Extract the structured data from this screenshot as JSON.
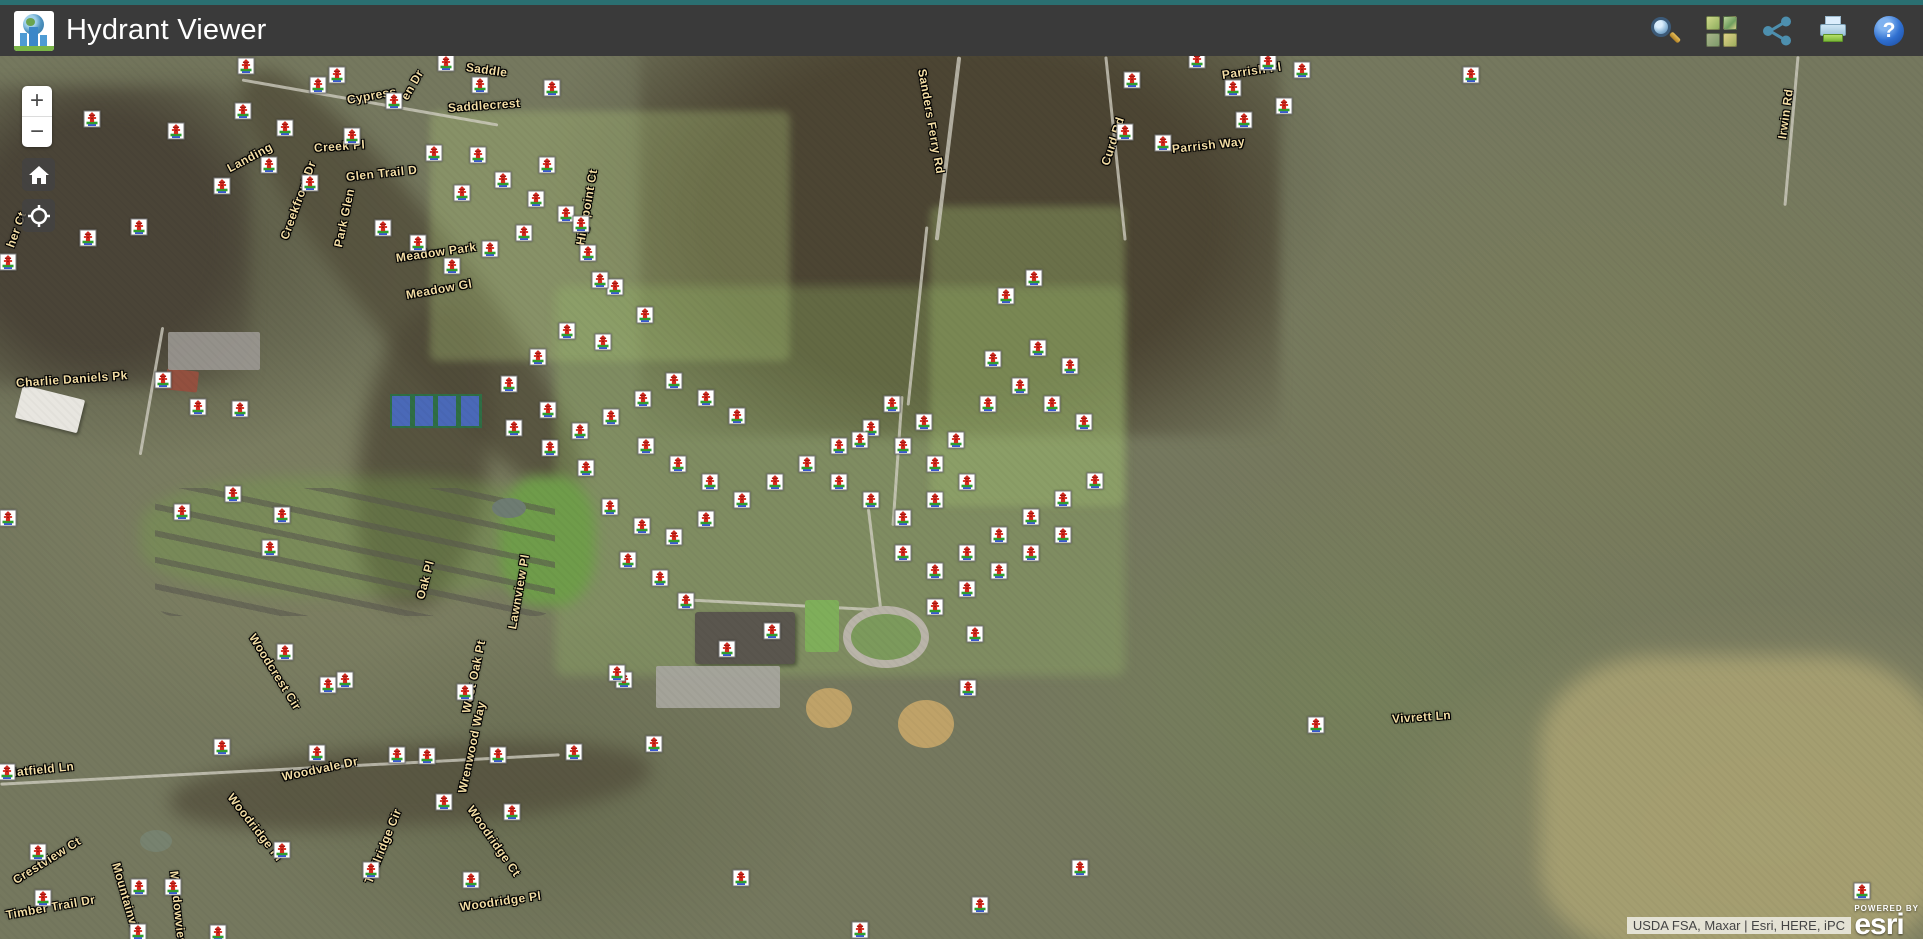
{
  "header": {
    "title": "Hydrant Viewer",
    "toolbar": [
      {
        "icon": "search-icon"
      },
      {
        "icon": "basemap-gallery-icon"
      },
      {
        "icon": "share-icon"
      },
      {
        "icon": "print-icon"
      },
      {
        "icon": "help-icon"
      }
    ]
  },
  "controls": {
    "zoom_in": "+",
    "zoom_out": "−"
  },
  "attribution": {
    "text": "USDA FSA, Maxar | Esri, HERE, iPC",
    "powered_by": "POWERED BY",
    "brand": "esri"
  },
  "colors": {
    "top_stripe": "#2a6f71",
    "header_bg": "#3a3a3a",
    "hydrant_red": "#d42a1e",
    "hydrant_grass": "#2e9e2e",
    "hydrant_blue": "#2244cc",
    "street_label": "#f3dda4"
  },
  "street_labels": [
    {
      "text": "Cypress",
      "x": 347,
      "y": 93,
      "rot": -10
    },
    {
      "text": "en Dr",
      "x": 404,
      "y": 92,
      "rot": -60
    },
    {
      "text": "Saddle",
      "x": 466,
      "y": 60,
      "rot": 8
    },
    {
      "text": "Saddlecrest",
      "x": 448,
      "y": 101,
      "rot": -4
    },
    {
      "text": "Creek Pl",
      "x": 314,
      "y": 141,
      "rot": -4
    },
    {
      "text": "Landing",
      "x": 228,
      "y": 162,
      "rot": -28
    },
    {
      "text": "Creekfront Dr",
      "x": 284,
      "y": 232,
      "rot": -70
    },
    {
      "text": "Glen Trail D",
      "x": 346,
      "y": 170,
      "rot": -6
    },
    {
      "text": "Park Glen",
      "x": 338,
      "y": 240,
      "rot": -78
    },
    {
      "text": "Highpoint Ct",
      "x": 580,
      "y": 238,
      "rot": -80
    },
    {
      "text": "Meadow Park",
      "x": 396,
      "y": 251,
      "rot": -8
    },
    {
      "text": "Meadow Gl",
      "x": 406,
      "y": 288,
      "rot": -10
    },
    {
      "text": "Sanders Ferry Rd",
      "x": 922,
      "y": 62,
      "rot": 80
    },
    {
      "text": "Curd Rd",
      "x": 1105,
      "y": 158,
      "rot": -72
    },
    {
      "text": "Parrish Pl",
      "x": 1222,
      "y": 68,
      "rot": -8
    },
    {
      "text": "Parrish Way",
      "x": 1172,
      "y": 142,
      "rot": -6
    },
    {
      "text": "Irwin Rd",
      "x": 1782,
      "y": 132,
      "rot": -82
    },
    {
      "text": "Charlie Daniels Pk",
      "x": 16,
      "y": 376,
      "rot": -4
    },
    {
      "text": "her Ct",
      "x": 10,
      "y": 240,
      "rot": -70
    },
    {
      "text": "Woodcrest Cir",
      "x": 252,
      "y": 628,
      "rot": 58
    },
    {
      "text": "Woodvale Dr",
      "x": 282,
      "y": 770,
      "rot": -12
    },
    {
      "text": "Wrenwood Way",
      "x": 462,
      "y": 786,
      "rot": -78
    },
    {
      "text": "West Oak Pt",
      "x": 466,
      "y": 706,
      "rot": -78
    },
    {
      "text": "Oak Pl",
      "x": 420,
      "y": 592,
      "rot": -75
    },
    {
      "text": "Lawnview Pl",
      "x": 512,
      "y": 622,
      "rot": -80
    },
    {
      "text": "Hatfield Ln",
      "x": 8,
      "y": 766,
      "rot": -6
    },
    {
      "text": "Crestview Ct",
      "x": 14,
      "y": 874,
      "rot": -32
    },
    {
      "text": "Timber Trail Dr",
      "x": 6,
      "y": 908,
      "rot": -10
    },
    {
      "text": "Mountainview Dr",
      "x": 116,
      "y": 856,
      "rot": 74
    },
    {
      "text": "Meadowview Ln",
      "x": 174,
      "y": 864,
      "rot": 84
    },
    {
      "text": "Woodridge Pl",
      "x": 230,
      "y": 788,
      "rot": 52
    },
    {
      "text": "Trailridge Cir",
      "x": 368,
      "y": 876,
      "rot": -68
    },
    {
      "text": "Woodridge Ct",
      "x": 470,
      "y": 800,
      "rot": 55
    },
    {
      "text": "Woodridge Pl",
      "x": 460,
      "y": 900,
      "rot": -8
    },
    {
      "text": "Vivrett Ln",
      "x": 1392,
      "y": 712,
      "rot": -4
    }
  ],
  "hydrants": [
    [
      337,
      75
    ],
    [
      394,
      101
    ],
    [
      480,
      85
    ],
    [
      552,
      88
    ],
    [
      285,
      128
    ],
    [
      434,
      153
    ],
    [
      478,
      155
    ],
    [
      547,
      165
    ],
    [
      92,
      119
    ],
    [
      176,
      131
    ],
    [
      243,
      111
    ],
    [
      222,
      186
    ],
    [
      139,
      227
    ],
    [
      88,
      238
    ],
    [
      8,
      262
    ],
    [
      269,
      165
    ],
    [
      310,
      183
    ],
    [
      352,
      136
    ],
    [
      246,
      66
    ],
    [
      318,
      85
    ],
    [
      446,
      63
    ],
    [
      1132,
      80
    ],
    [
      1125,
      132
    ],
    [
      1163,
      143
    ],
    [
      1197,
      60
    ],
    [
      1233,
      88
    ],
    [
      1268,
      62
    ],
    [
      1284,
      106
    ],
    [
      1302,
      70
    ],
    [
      1244,
      120
    ],
    [
      1471,
      75
    ],
    [
      462,
      193
    ],
    [
      503,
      180
    ],
    [
      536,
      199
    ],
    [
      566,
      214
    ],
    [
      524,
      233
    ],
    [
      490,
      249
    ],
    [
      452,
      266
    ],
    [
      418,
      243
    ],
    [
      383,
      228
    ],
    [
      581,
      224
    ],
    [
      588,
      253
    ],
    [
      615,
      287
    ],
    [
      645,
      315
    ],
    [
      600,
      280
    ],
    [
      603,
      342
    ],
    [
      567,
      331
    ],
    [
      538,
      357
    ],
    [
      509,
      384
    ],
    [
      548,
      410
    ],
    [
      580,
      431
    ],
    [
      611,
      417
    ],
    [
      643,
      399
    ],
    [
      674,
      381
    ],
    [
      706,
      398
    ],
    [
      737,
      416
    ],
    [
      646,
      446
    ],
    [
      678,
      464
    ],
    [
      710,
      482
    ],
    [
      742,
      500
    ],
    [
      706,
      519
    ],
    [
      674,
      537
    ],
    [
      642,
      526
    ],
    [
      610,
      507
    ],
    [
      586,
      468
    ],
    [
      550,
      448
    ],
    [
      514,
      428
    ],
    [
      628,
      560
    ],
    [
      660,
      578
    ],
    [
      775,
      482
    ],
    [
      807,
      464
    ],
    [
      839,
      482
    ],
    [
      871,
      500
    ],
    [
      903,
      518
    ],
    [
      935,
      500
    ],
    [
      967,
      482
    ],
    [
      935,
      464
    ],
    [
      903,
      446
    ],
    [
      871,
      428
    ],
    [
      839,
      446
    ],
    [
      903,
      553
    ],
    [
      935,
      571
    ],
    [
      967,
      553
    ],
    [
      999,
      535
    ],
    [
      1031,
      517
    ],
    [
      1063,
      499
    ],
    [
      1095,
      481
    ],
    [
      1063,
      535
    ],
    [
      1031,
      553
    ],
    [
      999,
      571
    ],
    [
      967,
      589
    ],
    [
      935,
      607
    ],
    [
      860,
      440
    ],
    [
      892,
      404
    ],
    [
      924,
      422
    ],
    [
      956,
      440
    ],
    [
      988,
      404
    ],
    [
      1020,
      386
    ],
    [
      1052,
      404
    ],
    [
      1084,
      422
    ],
    [
      1006,
      296
    ],
    [
      1034,
      278
    ],
    [
      1038,
      348
    ],
    [
      1070,
      366
    ],
    [
      993,
      359
    ],
    [
      163,
      380
    ],
    [
      198,
      407
    ],
    [
      240,
      409
    ],
    [
      8,
      518
    ],
    [
      233,
      494
    ],
    [
      182,
      512
    ],
    [
      282,
      515
    ],
    [
      270,
      548
    ],
    [
      285,
      652
    ],
    [
      328,
      685
    ],
    [
      345,
      680
    ],
    [
      465,
      692
    ],
    [
      317,
      753
    ],
    [
      397,
      755
    ],
    [
      427,
      756
    ],
    [
      498,
      755
    ],
    [
      574,
      752
    ],
    [
      624,
      680
    ],
    [
      222,
      747
    ],
    [
      7,
      772
    ],
    [
      38,
      852
    ],
    [
      43,
      898
    ],
    [
      139,
      887
    ],
    [
      173,
      887
    ],
    [
      282,
      850
    ],
    [
      371,
      870
    ],
    [
      444,
      802
    ],
    [
      471,
      880
    ],
    [
      512,
      812
    ],
    [
      138,
      932
    ],
    [
      218,
      933
    ],
    [
      686,
      601
    ],
    [
      727,
      649
    ],
    [
      772,
      631
    ],
    [
      975,
      634
    ],
    [
      968,
      688
    ],
    [
      654,
      744
    ],
    [
      741,
      878
    ],
    [
      980,
      905
    ],
    [
      1080,
      868
    ],
    [
      860,
      930
    ],
    [
      617,
      673
    ],
    [
      1316,
      725
    ],
    [
      1862,
      891
    ]
  ]
}
